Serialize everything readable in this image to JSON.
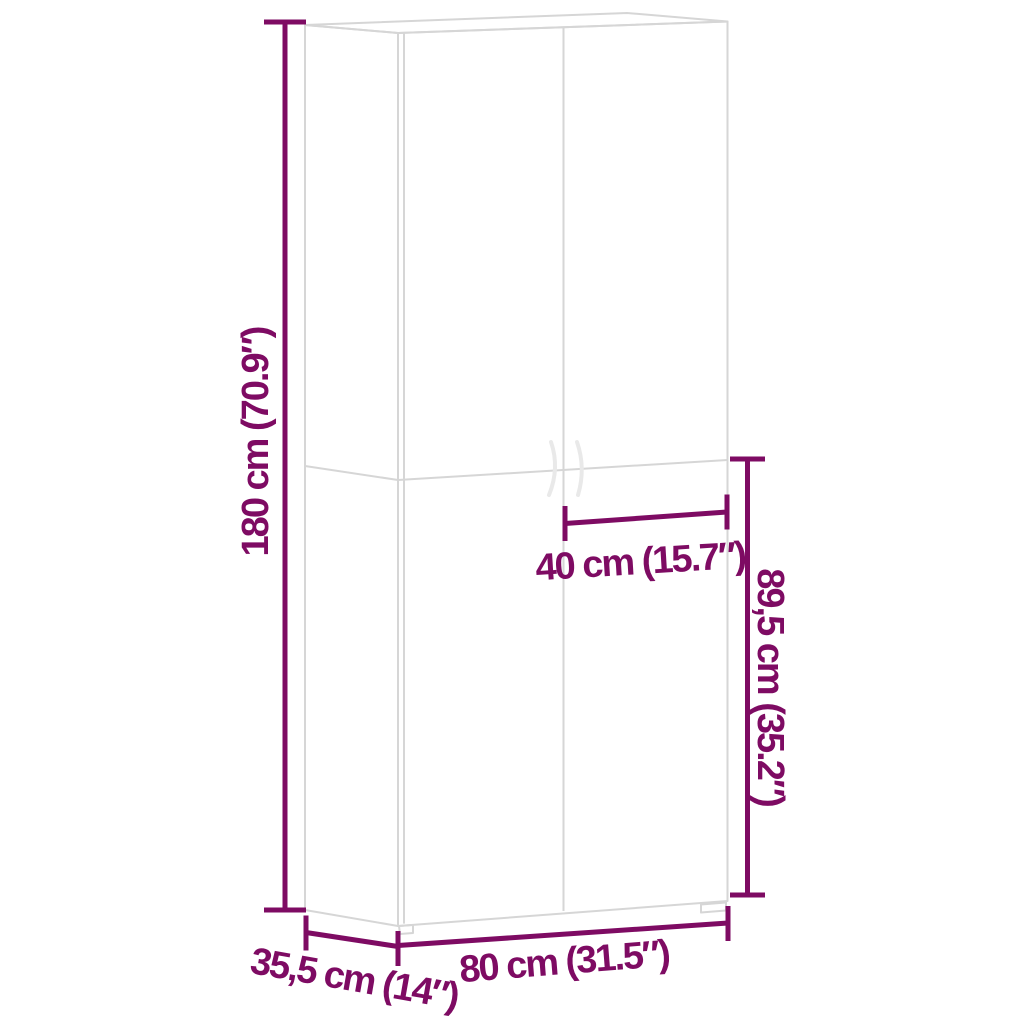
{
  "diagram": {
    "background": "#ffffff",
    "accent_color": "#7e0b63",
    "outline_color": "#d6d6d6",
    "labels": {
      "height": "180 cm (70.9″)",
      "door_width": "40 cm (15.7″)",
      "lower_height": "89,5 cm (35.2″)",
      "depth": "35,5 cm (14″)",
      "width": "80 cm (31.5″)"
    },
    "measurements": [
      {
        "name": "height",
        "cm": "180",
        "inch": "70.9″"
      },
      {
        "name": "door-width",
        "cm": "40",
        "inch": "15.7″"
      },
      {
        "name": "lower-section-height",
        "cm": "89,5",
        "inch": "35.2″"
      },
      {
        "name": "depth",
        "cm": "35,5",
        "inch": "14″"
      },
      {
        "name": "width",
        "cm": "80",
        "inch": "31.5″"
      }
    ]
  }
}
